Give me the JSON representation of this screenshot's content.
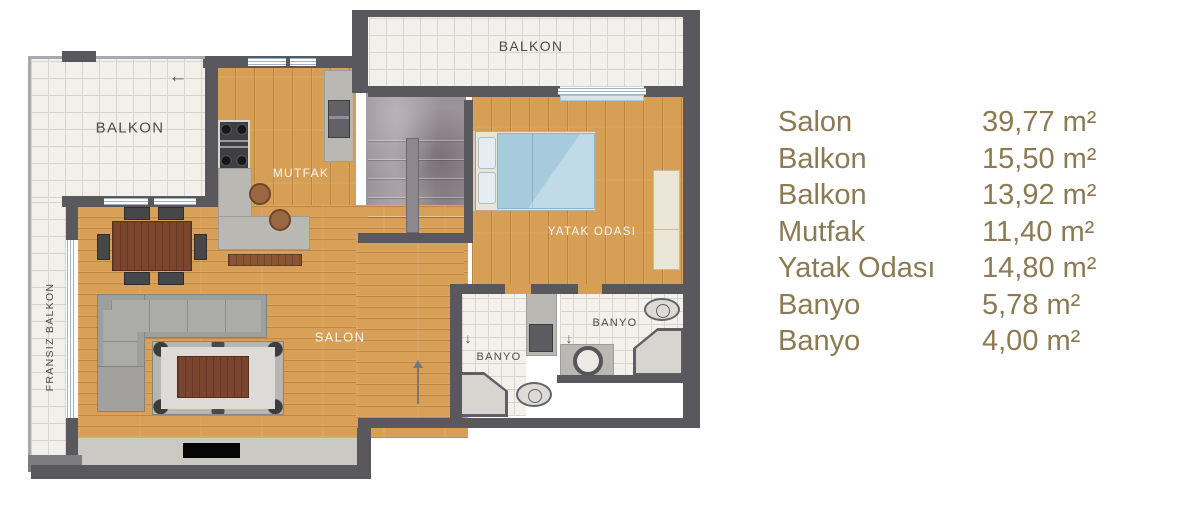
{
  "plan": {
    "labels": {
      "balkon_top": "BALKON",
      "balkon_left": "BALKON",
      "fransiz_balkon": "FRANSIZ BALKON",
      "mutfak": "MUTFAK",
      "salon": "SALON",
      "yatak_odasi": "YATAK ODASI",
      "banyo_left": "BANYO",
      "banyo_right": "BANYO"
    },
    "icons": {
      "entry_arrow": "←",
      "door_arrow_left_bath": "↓",
      "door_arrow_right_bath": "↓",
      "door_leaf_arrow": "▲"
    },
    "colors": {
      "wall": "#59585c",
      "wood_floor": "#d79e55",
      "tile_floor": "#f2f0eb",
      "marble_floor": "#9c9398",
      "bed_blue": "#a5cbdd",
      "sofa_gray": "#9e9e9b",
      "table_brown": "#7c462e",
      "counter_gray": "#bab8b3",
      "legend_text": "#8b7a52"
    }
  },
  "legend": {
    "rows": [
      {
        "label": "Salon",
        "value": "39,77 m²"
      },
      {
        "label": "Balkon",
        "value": "15,50 m²"
      },
      {
        "label": "Balkon",
        "value": "13,92 m²"
      },
      {
        "label": "Mutfak",
        "value": "11,40 m²"
      },
      {
        "label": "Yatak Odası",
        "value": "14,80 m²"
      },
      {
        "label": "Banyo",
        "value": "5,78 m²"
      },
      {
        "label": "Banyo",
        "value": "4,00 m²"
      }
    ]
  }
}
